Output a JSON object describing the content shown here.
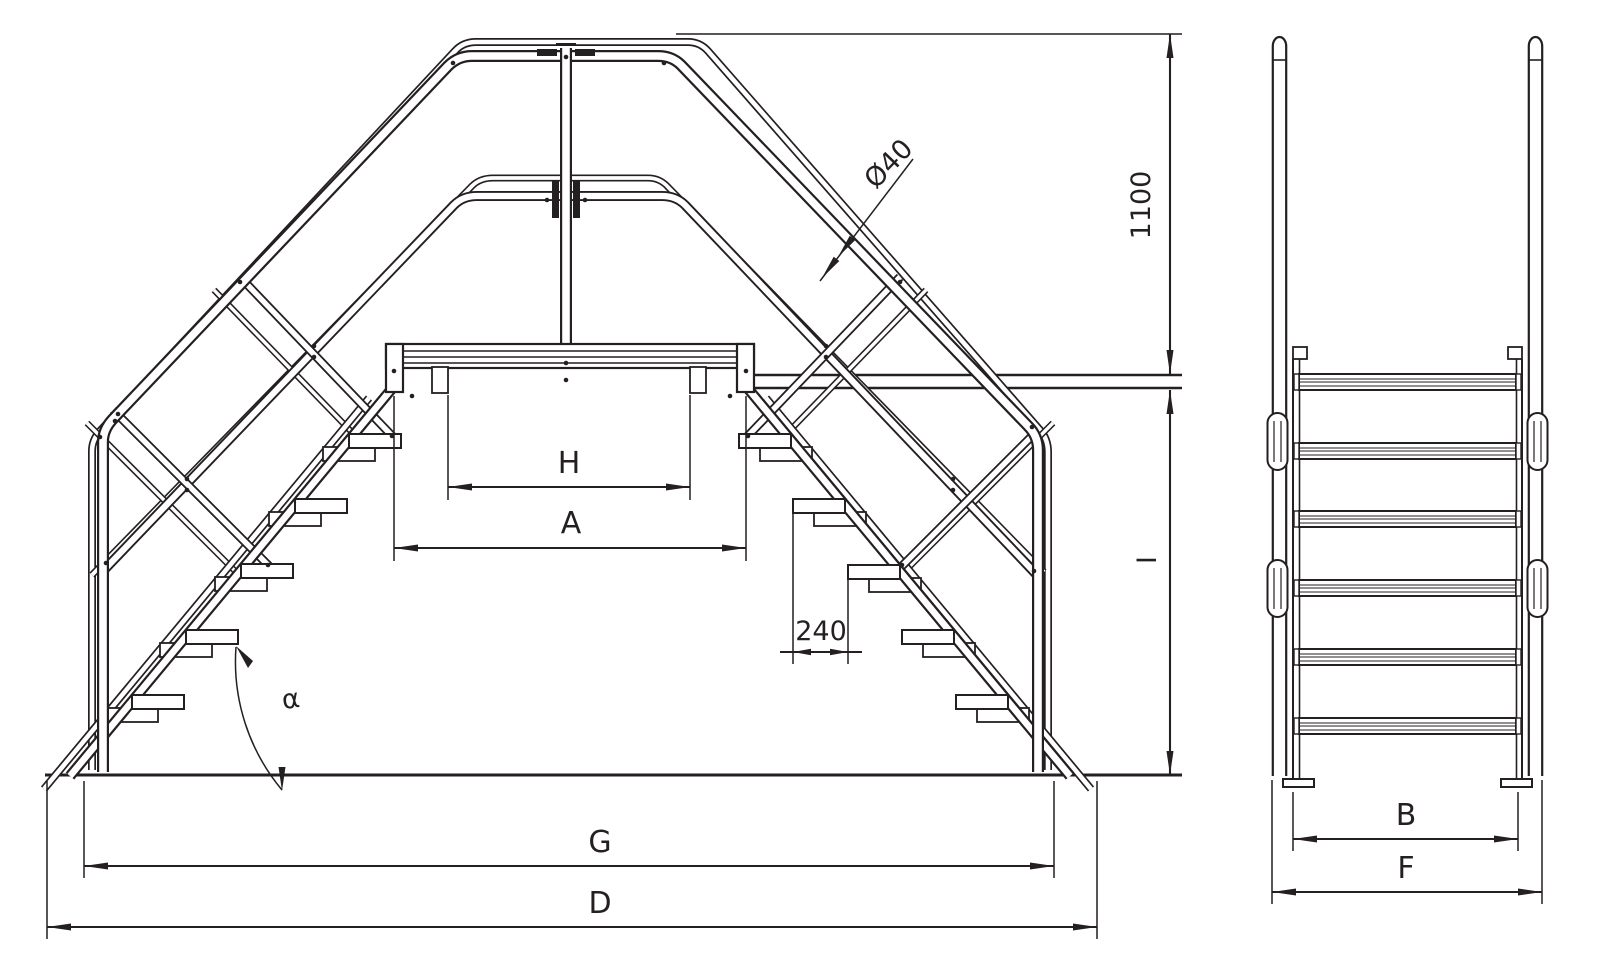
{
  "page": {
    "background": "#ffffff",
    "line_color": "#241f21",
    "description": "Technical line drawing of a crossover platform stair (front elevation and side elevation) with dimension callouts"
  },
  "drawing": {
    "views": {
      "front": {
        "name": "front-elevation",
        "dimensions": [
          {
            "id": "tube-diameter",
            "label": "Ø40"
          },
          {
            "id": "handrail-height",
            "label": "1100"
          },
          {
            "id": "platform-height",
            "label": "I"
          },
          {
            "id": "clear-width",
            "label": "H"
          },
          {
            "id": "platform-length",
            "label": "A"
          },
          {
            "id": "step-pitch",
            "label": "240"
          },
          {
            "id": "stair-angle",
            "label": "α"
          },
          {
            "id": "base-span-inner",
            "label": "G"
          },
          {
            "id": "base-span-overall",
            "label": "D"
          }
        ]
      },
      "side": {
        "name": "side-elevation",
        "dimensions": [
          {
            "id": "tread-width",
            "label": "B"
          },
          {
            "id": "overall-width",
            "label": "F"
          }
        ]
      }
    }
  }
}
